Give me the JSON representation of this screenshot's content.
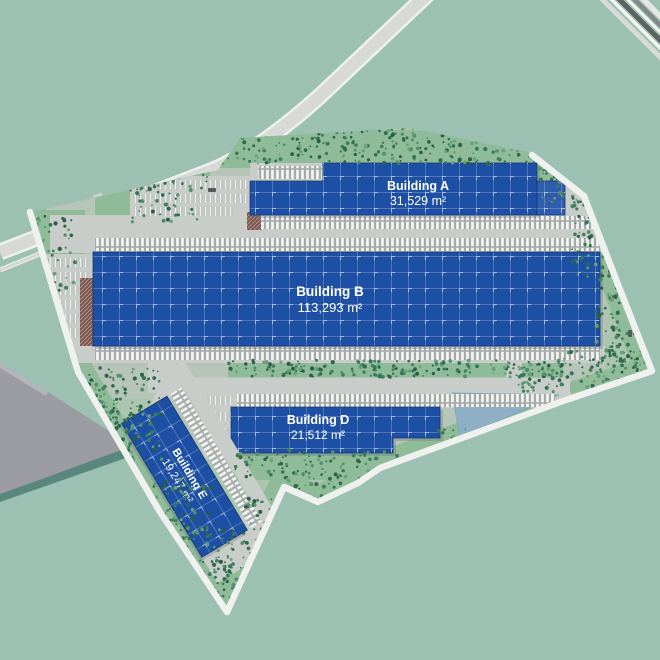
{
  "title": "Logistics park site plan",
  "site": {
    "buildings": [
      {
        "key": "a",
        "name": "Building A",
        "area": "31,529 m²"
      },
      {
        "key": "b",
        "name": "Building B",
        "area": "113,293 m²"
      },
      {
        "key": "d",
        "name": "Building D",
        "area": "21,512 m²"
      },
      {
        "key": "e",
        "name": "Building E",
        "area": "19,247 m²"
      }
    ]
  },
  "legend_icons": {
    "building_roof": "blue-solar-roof",
    "pond": "retention-pond",
    "rail": "railway-tracks",
    "trees": "tree-cluster"
  },
  "colors": {
    "background_outside": "#9cc0b1",
    "background_inside": "#abc5af",
    "pad_concrete": "#b7c4b8",
    "roof_blue": "#1d4fa4",
    "roof_annex_blue": "#2f5cae",
    "roof_grid_line": "#ffffff",
    "office_brown": "#7d564e",
    "apron_gray": "#c9cdca",
    "road_gray": "#d6d9d6",
    "road_edge_white": "#eef0ed",
    "perimeter_road_white": "#eef1ee",
    "grass_green": "#8fbb98",
    "tree_dark_green": "#2d6a4c",
    "pond_blue": "#8fb0c4",
    "neighbor_building_gray": "#9b9ba2",
    "neighbor_shadow_teal": "#4f7d74",
    "rail_dark_gray": "#5d6164",
    "label_text": "#ffffff"
  }
}
